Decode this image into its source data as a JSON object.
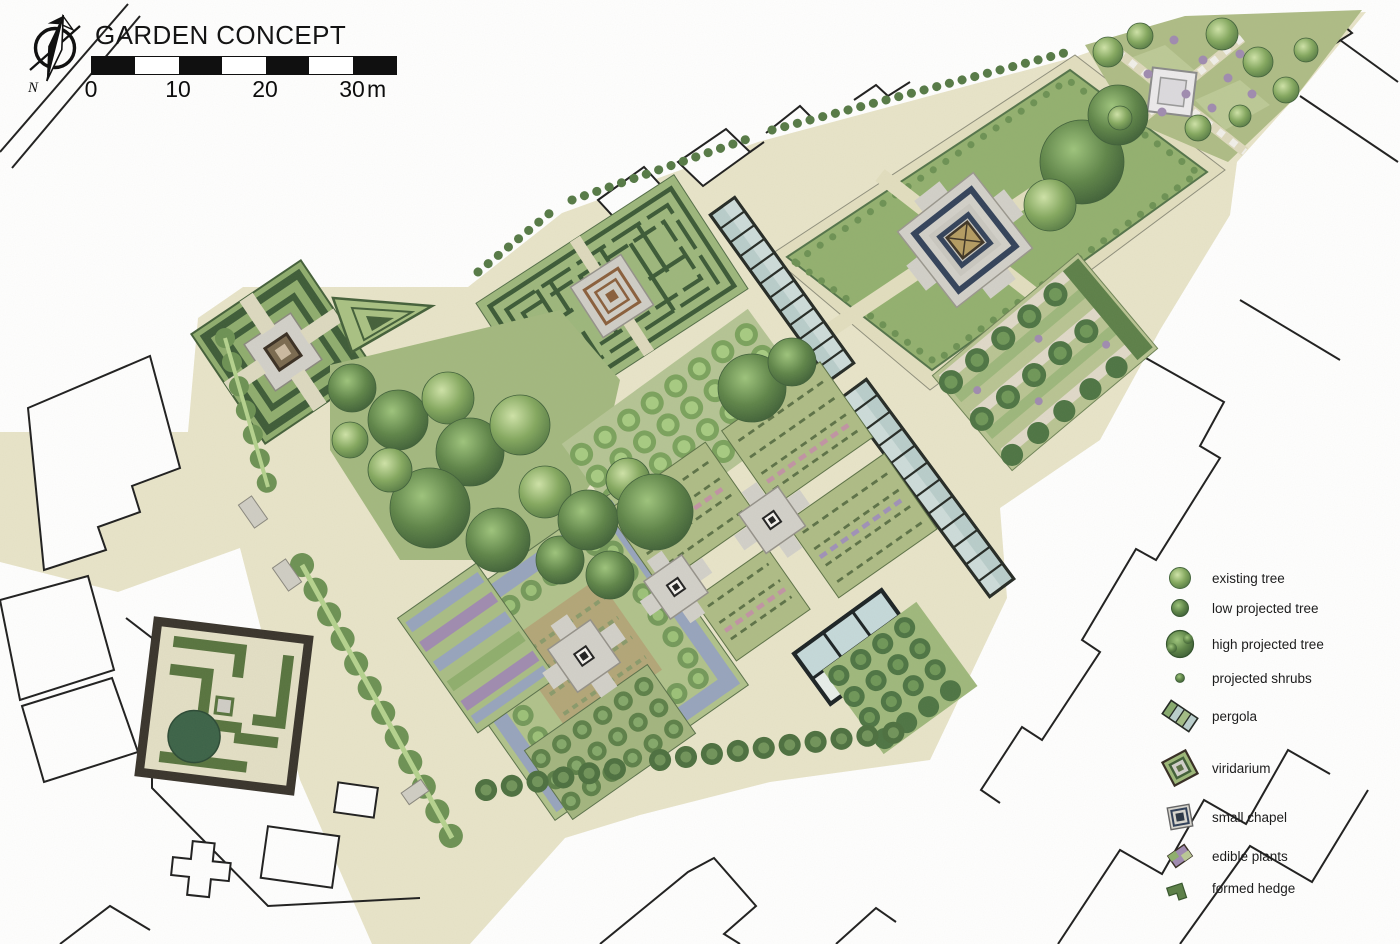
{
  "header": {
    "title": "GARDEN CONCEPT",
    "north_label": "N"
  },
  "scale_bar": {
    "tick_labels": [
      "0",
      "10",
      "20",
      "30"
    ],
    "unit": "m"
  },
  "legend": {
    "items": [
      {
        "id": "existing-tree",
        "label": "existing tree"
      },
      {
        "id": "low-projected-tree",
        "label": "low projected tree"
      },
      {
        "id": "high-projected-tree",
        "label": "high projected tree"
      },
      {
        "id": "projected-shrubs",
        "label": "projected shrubs"
      },
      {
        "id": "pergola",
        "label": "pergola"
      },
      {
        "id": "viridarium",
        "label": "viridarium"
      },
      {
        "id": "small-chapel",
        "label": "small chapel"
      },
      {
        "id": "edible-plants",
        "label": "edible plants"
      },
      {
        "id": "formed-hedge",
        "label": "formed hedge"
      }
    ]
  },
  "map": {
    "type": "garden masterplan",
    "colors": {
      "ground": "#e8e4c9",
      "lawn": "#93b06f",
      "parcel": "#aebc86",
      "hedge": "#44603a",
      "hedge-dot": "#6d9254",
      "plaza": "#d2d0c9",
      "glass": "#b9cdcb",
      "purple": "#a08bb0",
      "blue-bed": "#97a4bd",
      "tan-bed": "#b3a678",
      "navy": "#33425a",
      "gold": "#b49c62",
      "outline": "#1f1f1f"
    }
  }
}
